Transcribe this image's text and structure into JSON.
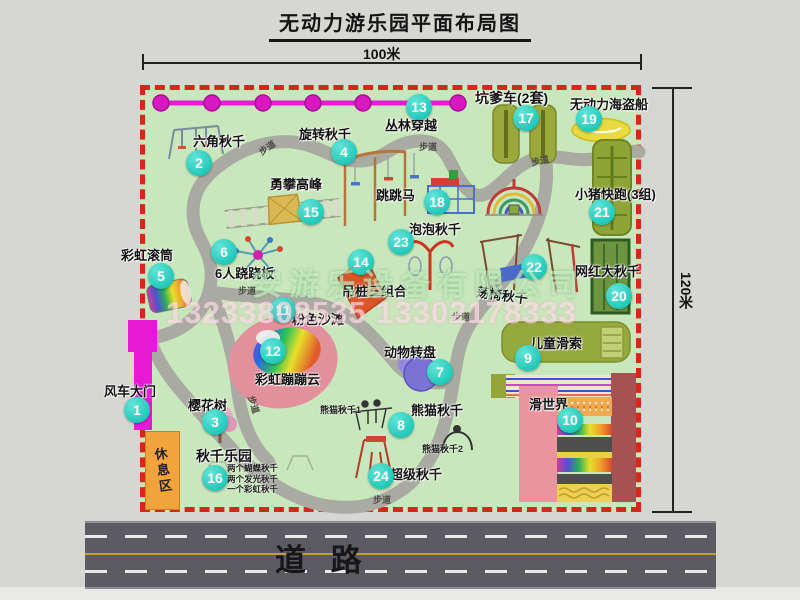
{
  "title": "无动力游乐园平面布局图",
  "scale": {
    "width_label": "100米",
    "height_label": "120米"
  },
  "road_label": "道  路",
  "rest_area_label": "休息区",
  "path_label_text": "步道",
  "watermark": {
    "company": "安游乐设备有限公司",
    "phone": "13233808535 13302178333"
  },
  "swing_park_notes": [
    "两个蝴蝶秋千",
    "两个发光秋千",
    "一个彩虹秋千"
  ],
  "colors": {
    "map_bg": "#c9e7bc",
    "border_red": "#d4281c",
    "badge_cyan": "#22c9ba",
    "gate_magenta": "#e51ad2",
    "zipline_magenta": "#e21fd2",
    "rest_area_orange": "#f2a33c",
    "road_gray": "#5b5b61",
    "path_gray": "#a9aba3"
  },
  "attractions": [
    {
      "n": 1,
      "label": "风车大门",
      "lx": 104,
      "ly": 381,
      "bx": 137,
      "by": 410
    },
    {
      "n": 2,
      "label": "六角秋千",
      "lx": 193,
      "ly": 131,
      "bx": 199,
      "by": 163
    },
    {
      "n": 3,
      "label": "樱花树",
      "lx": 188,
      "ly": 395,
      "bx": 215,
      "by": 422
    },
    {
      "n": 4,
      "label": "旋转秋千",
      "lx": 299,
      "ly": 124,
      "bx": 344,
      "by": 152
    },
    {
      "n": 5,
      "label": "彩虹滚筒",
      "lx": 121,
      "ly": 245,
      "bx": 161,
      "by": 276
    },
    {
      "n": 6,
      "label": "6人跷跷板",
      "lx": 215,
      "ly": 263,
      "bx": 224,
      "by": 252
    },
    {
      "n": 7,
      "label": "动物转盘",
      "lx": 384,
      "ly": 342,
      "bx": 440,
      "by": 372
    },
    {
      "n": 8,
      "label": "熊猫秋千",
      "lx": 411,
      "ly": 400,
      "bx": 401,
      "by": 425
    },
    {
      "n": 9,
      "label": "儿童滑索",
      "lx": 530,
      "ly": 333,
      "bx": 528,
      "by": 358
    },
    {
      "n": 10,
      "label": "滑世界",
      "lx": 529,
      "ly": 394,
      "bx": 570,
      "by": 420
    },
    {
      "n": 11,
      "label": "粉色沙滩",
      "lx": 292,
      "ly": 309,
      "bx": 283,
      "by": 310
    },
    {
      "n": 12,
      "label": "彩虹蹦蹦云",
      "lx": 255,
      "ly": 369,
      "bx": 273,
      "by": 351
    },
    {
      "n": 13,
      "label": "丛林穿越",
      "lx": 385,
      "ly": 115,
      "bx": 419,
      "by": 107
    },
    {
      "n": 14,
      "label": "吊桩三组合",
      "lx": 342,
      "ly": 281,
      "bx": 361,
      "by": 262
    },
    {
      "n": 15,
      "label": "勇攀高峰",
      "lx": 270,
      "ly": 174,
      "bx": 311,
      "by": 212
    },
    {
      "n": 16,
      "label": "秋千乐园",
      "lx": 196,
      "ly": 446,
      "bx": 215,
      "by": 478,
      "size": "big"
    },
    {
      "n": 17,
      "label": "坑爹车(2套)",
      "lx": 475,
      "ly": 88,
      "bx": 526,
      "by": 118,
      "size": "big"
    },
    {
      "n": 18,
      "label": "跳跳马",
      "lx": 376,
      "ly": 185,
      "bx": 437,
      "by": 202
    },
    {
      "n": 19,
      "label": "无动力海盗船",
      "lx": 570,
      "ly": 94,
      "bx": 589,
      "by": 119
    },
    {
      "n": 20,
      "label": "网红大秋千",
      "lx": 575,
      "ly": 261,
      "bx": 619,
      "by": 296
    },
    {
      "n": 21,
      "label": "小猪快跑(3组)",
      "lx": 575,
      "ly": 184,
      "bx": 602,
      "by": 212
    },
    {
      "n": 22,
      "label": "荡椅秋千",
      "lx": 476,
      "ly": 285,
      "bx": 534,
      "by": 267,
      "rot": 8
    },
    {
      "n": 23,
      "label": "泡泡秋千",
      "lx": 409,
      "ly": 219,
      "bx": 401,
      "by": 242
    },
    {
      "n": 24,
      "label": "超级秋千",
      "lx": 390,
      "ly": 464,
      "bx": 381,
      "by": 476
    }
  ],
  "sub_labels": [
    {
      "label": "熊猫秋千1",
      "x": 320,
      "y": 403
    },
    {
      "label": "熊猫秋千2",
      "x": 422,
      "y": 442
    }
  ],
  "path_labels": [
    {
      "x": 258,
      "y": 141,
      "rot": -35
    },
    {
      "x": 419,
      "y": 140,
      "rot": 0
    },
    {
      "x": 531,
      "y": 154,
      "rot": -12
    },
    {
      "x": 238,
      "y": 284,
      "rot": 0
    },
    {
      "x": 452,
      "y": 310,
      "rot": 0
    },
    {
      "x": 245,
      "y": 398,
      "rot": 72
    },
    {
      "x": 373,
      "y": 493,
      "rot": 0
    }
  ]
}
